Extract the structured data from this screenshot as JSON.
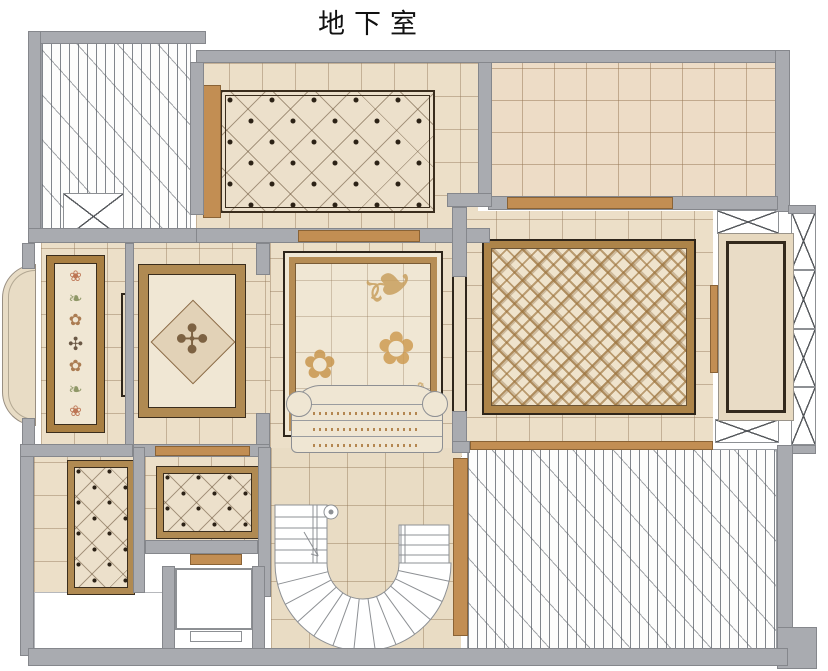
{
  "title": "地下室",
  "palette": {
    "wall": "#a9abb0",
    "wall_border": "#85878c",
    "tile": "#ecdfc8",
    "tile_line": "#927858",
    "rug_cream": "#f0e7d4",
    "rug_border_brown": "#b08a52",
    "dark_frame": "#2e251a",
    "wood_threshold": "#c28e53",
    "plank_floor": "#fdfdfc",
    "damask_gold": "#c89a58"
  },
  "rooms": [
    {
      "id": "top-left",
      "floor": "wood-plank"
    },
    {
      "id": "top-middle",
      "floor": "diamond-inlay-rug"
    },
    {
      "id": "top-right",
      "floor": "stone-tile-grid"
    },
    {
      "id": "left-runner",
      "floor": "mosaic-runner-rug"
    },
    {
      "id": "left-medallion",
      "floor": "medallion-rug"
    },
    {
      "id": "center-lounge",
      "floor": "damask-rug-with-sofa"
    },
    {
      "id": "right-lattice",
      "floor": "lattice-rug"
    },
    {
      "id": "bottom-left-small",
      "floor": "diamond-inlay-rug"
    },
    {
      "id": "bottom-left-wide",
      "floor": "diamond-inlay-rug"
    },
    {
      "id": "stair-hall",
      "floor": "stone-tile-with-curved-stair"
    },
    {
      "id": "bottom-right",
      "floor": "wood-plank"
    }
  ],
  "glyphs": {
    "damask": [
      "❧",
      "✿",
      "✿",
      "❧"
    ],
    "runner": [
      "❀",
      "❧",
      "✿",
      "✣",
      "✿",
      "❧",
      "❀"
    ],
    "medallion": "✣"
  }
}
